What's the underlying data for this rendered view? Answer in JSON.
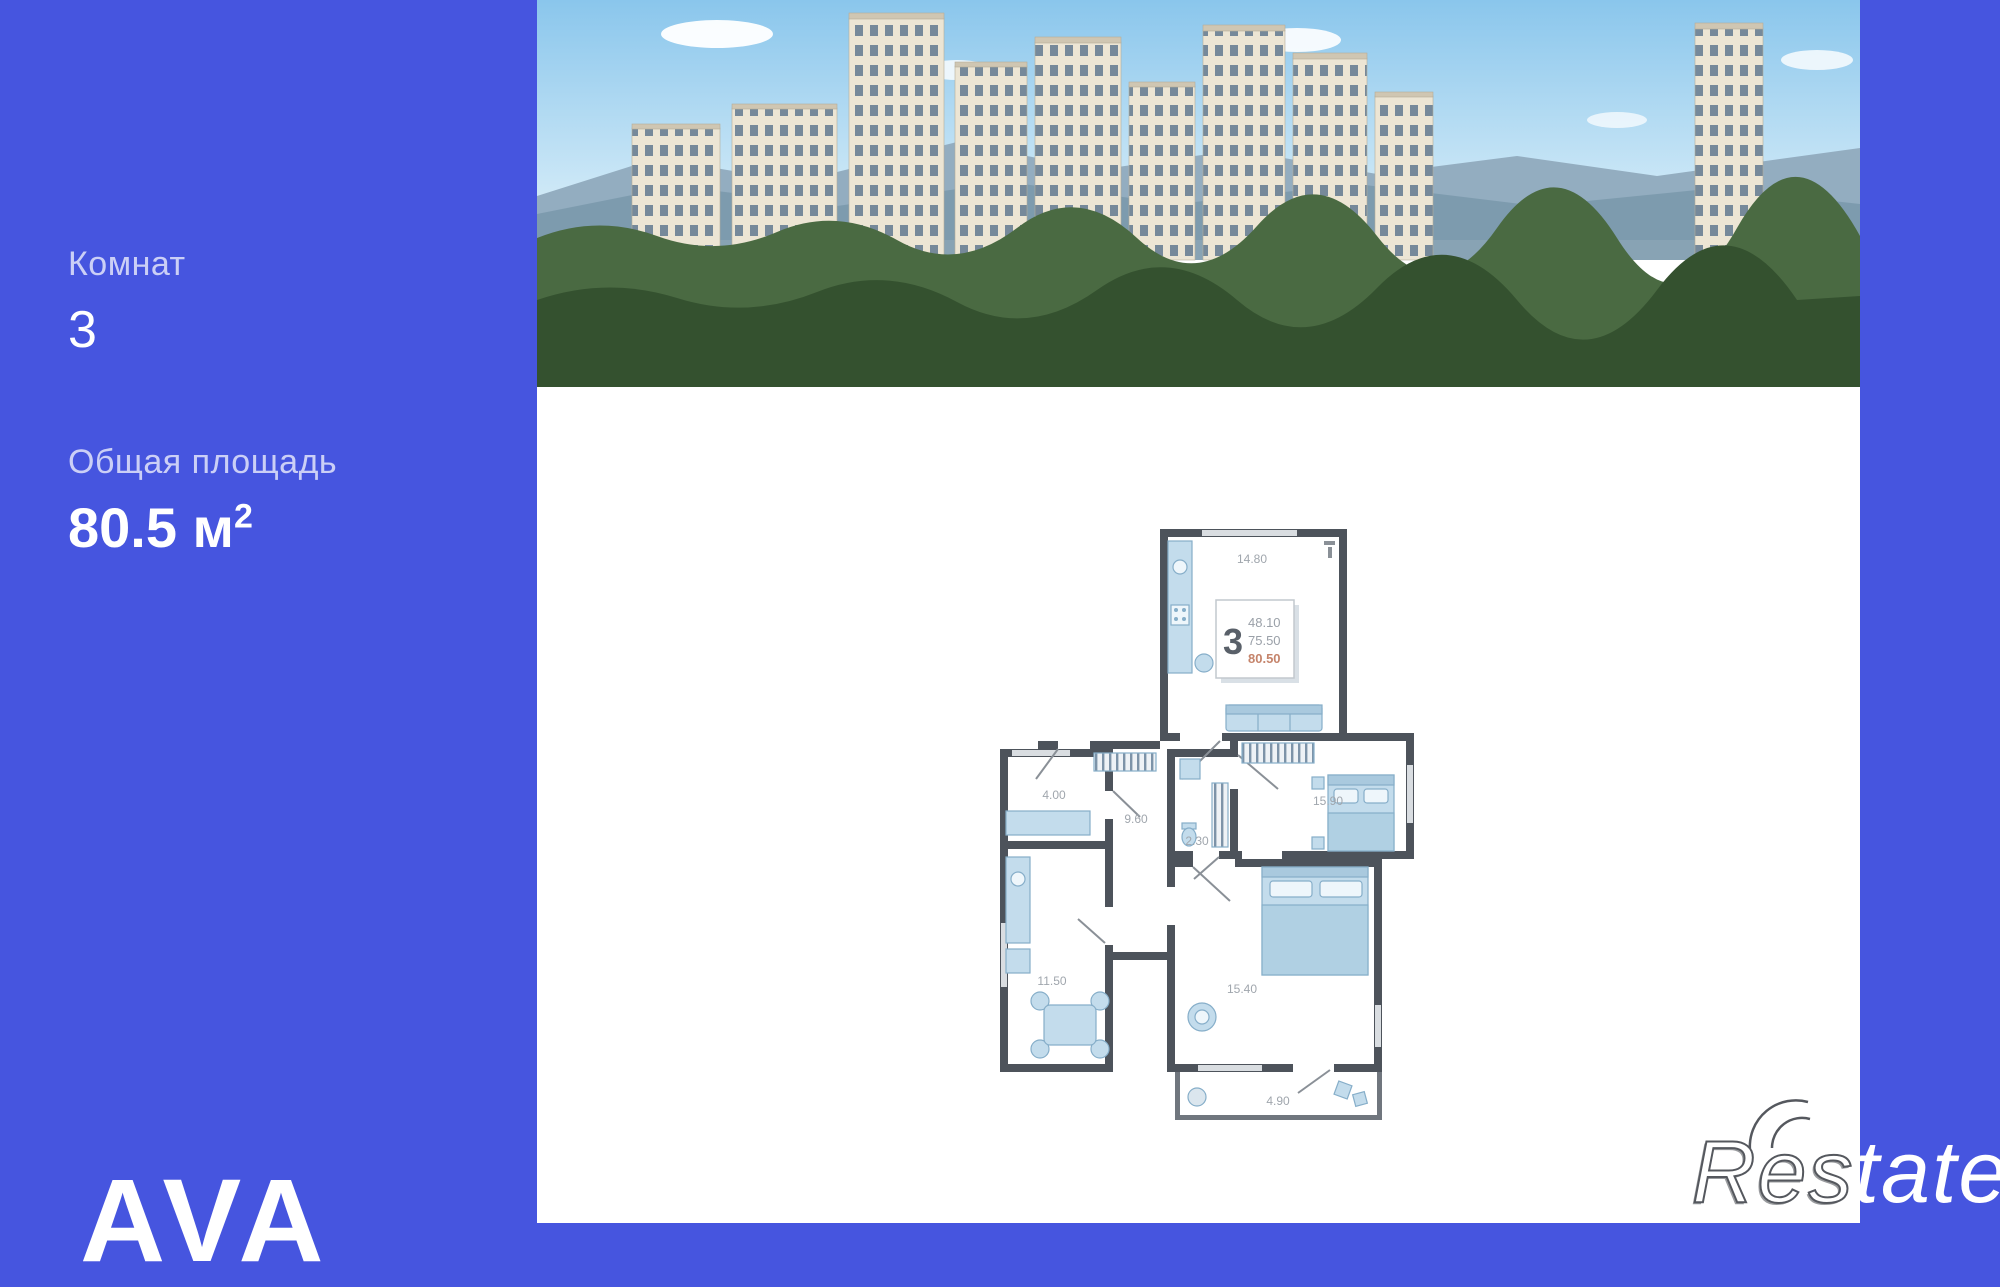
{
  "sidebar": {
    "rooms_label": "Комнат",
    "rooms_value": "3",
    "area_label": "Общая площадь",
    "area_value": "80.5 м",
    "area_sup": "2"
  },
  "branding": {
    "logo": "AVA",
    "watermark_outline": "Res",
    "watermark_solid": "tate"
  },
  "floorplan": {
    "stamp": {
      "rooms": "3",
      "living_area": "48.10",
      "area_no_balcony": "75.50",
      "total_area": "80.50"
    },
    "rooms": [
      {
        "name": "kitchen-living",
        "area": "14.80"
      },
      {
        "name": "hallway",
        "area": "9.60"
      },
      {
        "name": "bathroom",
        "area": "2.30"
      },
      {
        "name": "wardrobe-room",
        "area": "4.00"
      },
      {
        "name": "bedroom-right",
        "area": "15.90"
      },
      {
        "name": "kitchen",
        "area": "11.50"
      },
      {
        "name": "bedroom-bottom",
        "area": "15.40"
      },
      {
        "name": "balcony",
        "area": "4.90"
      }
    ]
  },
  "colors": {
    "background_blue": "#4655DF",
    "panel_white": "#ffffff",
    "wall_dark": "#4d535b",
    "furniture_blue": "#c3dcec",
    "furniture_stroke": "#86aec9",
    "room_label_gray": "#a0a6ad",
    "stamp_total_highlight": "#c5846b",
    "photo_sky": "#8ac6ec",
    "photo_forest": "#34512f",
    "building_cream": "#ece5d4"
  }
}
